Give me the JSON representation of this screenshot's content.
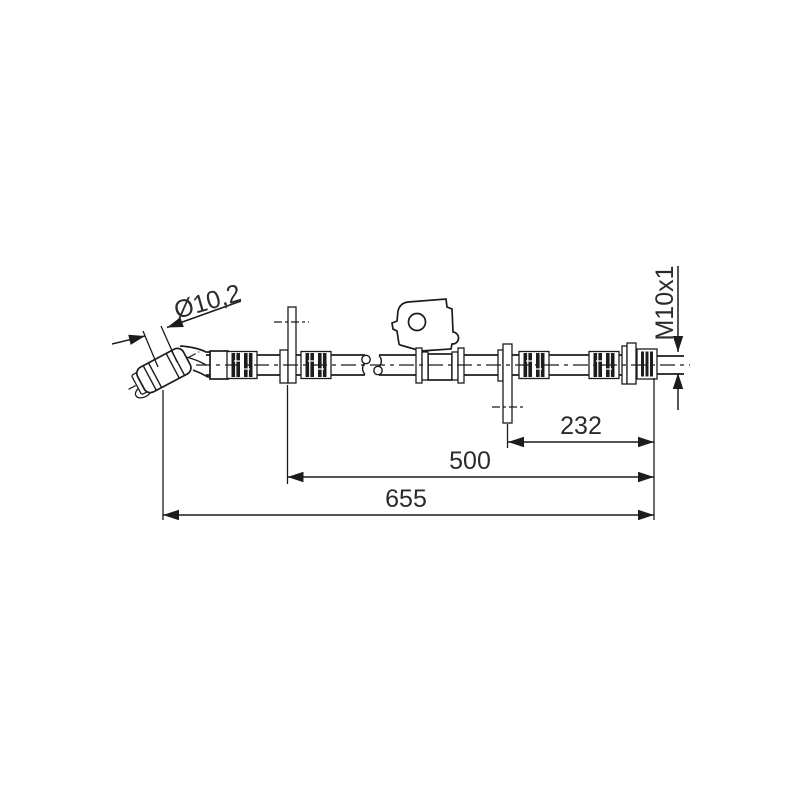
{
  "canvas": {
    "background": "#ffffff",
    "line_color": "#1c1c1c",
    "text_color": "#2b2b2b"
  },
  "drawing": {
    "annotations": {
      "hose_diameter": "Ø10,2",
      "thread_size": "M10x1"
    },
    "dimensions_mm": [
      {
        "name": "plate2-to-end",
        "label": "232"
      },
      {
        "name": "plate1-to-end",
        "label": "500"
      },
      {
        "name": "overall-length",
        "label": "655"
      }
    ]
  }
}
